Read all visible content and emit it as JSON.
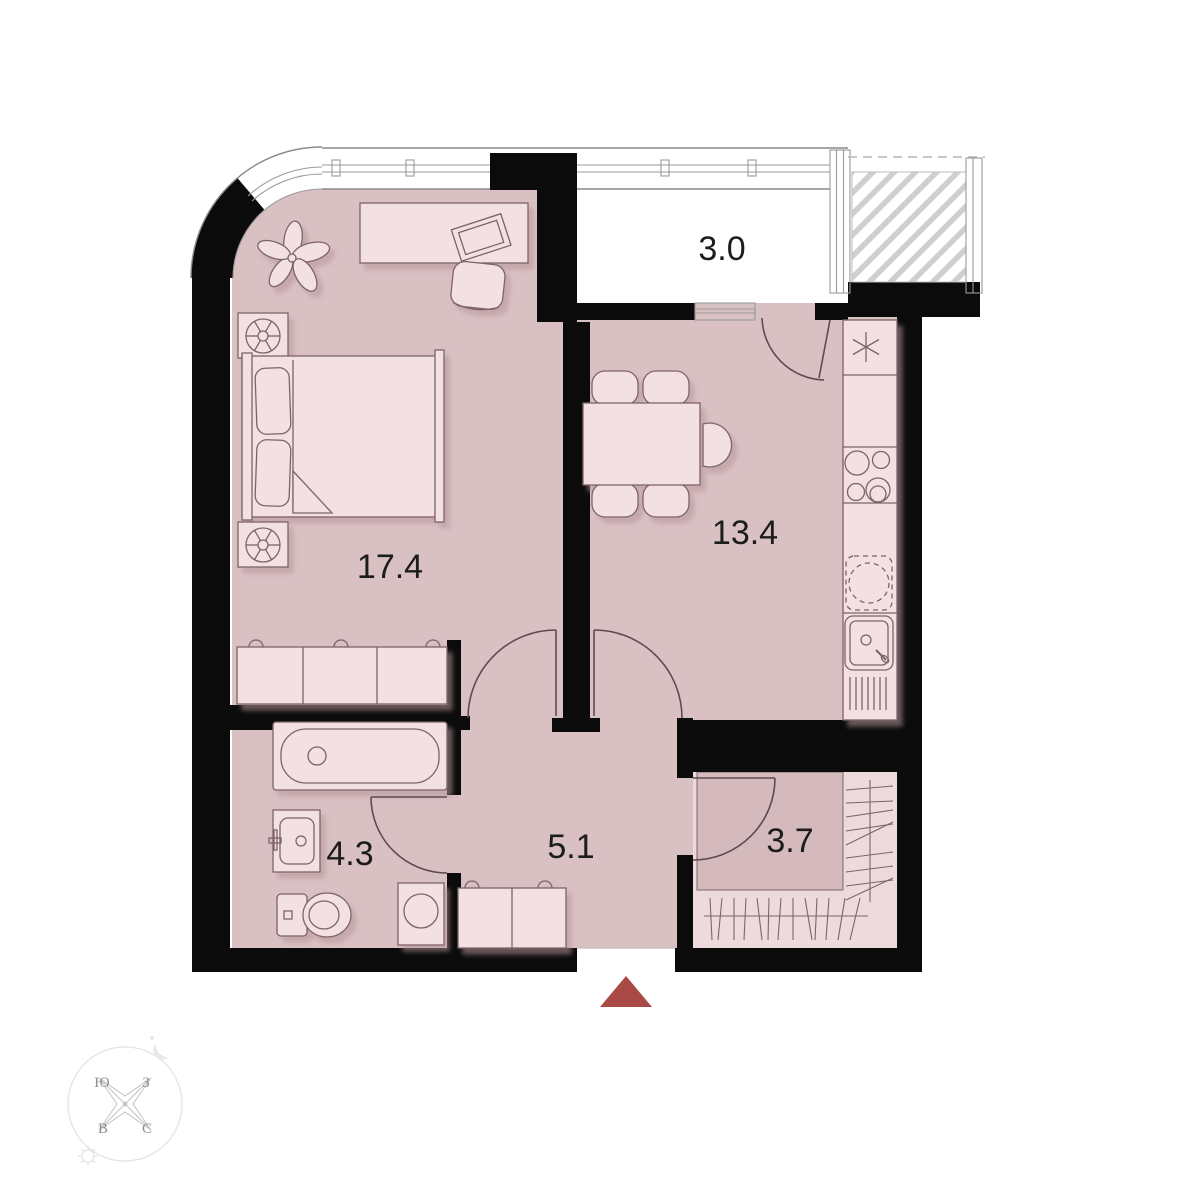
{
  "plan": {
    "title": "one-bedroom apartment floor plan",
    "rooms": [
      {
        "id": "bedroom",
        "area": "17.4"
      },
      {
        "id": "kitchen-living",
        "area": "13.4"
      },
      {
        "id": "balcony",
        "area": "3.0"
      },
      {
        "id": "hallway",
        "area": "5.1"
      },
      {
        "id": "bathroom",
        "area": "4.3"
      },
      {
        "id": "wardrobe",
        "area": "3.7"
      }
    ],
    "compass": {
      "south": "Ю",
      "west": "З",
      "east": "В",
      "north": "С"
    },
    "icons": [
      "entrance-arrow-icon",
      "compass-rose-icon",
      "sun-icon",
      "moon-icon",
      "bed-icon",
      "pillow-icon",
      "nightstand-lamp-icon",
      "desk-icon",
      "laptop-icon",
      "desk-chair-icon",
      "plant-icon",
      "dresser-icon",
      "dining-table-icon",
      "chair-icon",
      "kitchen-counter-icon",
      "stove-icon",
      "kitchen-sink-icon",
      "vent-asterisk-icon",
      "appliance-dashed-icon",
      "bathtub-icon",
      "washbasin-icon",
      "toilet-icon",
      "washing-machine-icon",
      "shoe-bench-icon",
      "wardrobe-rail-icon",
      "window-icon",
      "door-arc-icon",
      "hatched-neighbor-balcony"
    ],
    "colors": {
      "wall": "#0b0b0b",
      "floor": "#d9c0c3",
      "furniture": "#f2e0e2",
      "wardrobe_floor": "#ecdadc",
      "balcony_floor": "#ffffff",
      "entrance_arrow": "#a94a46",
      "outline": "#7d6468",
      "window_line": "#8a8a8a",
      "hatch": "#cfcfcf",
      "label_text": "#1c1c1c",
      "compass_text": "#8f8f8f"
    }
  }
}
